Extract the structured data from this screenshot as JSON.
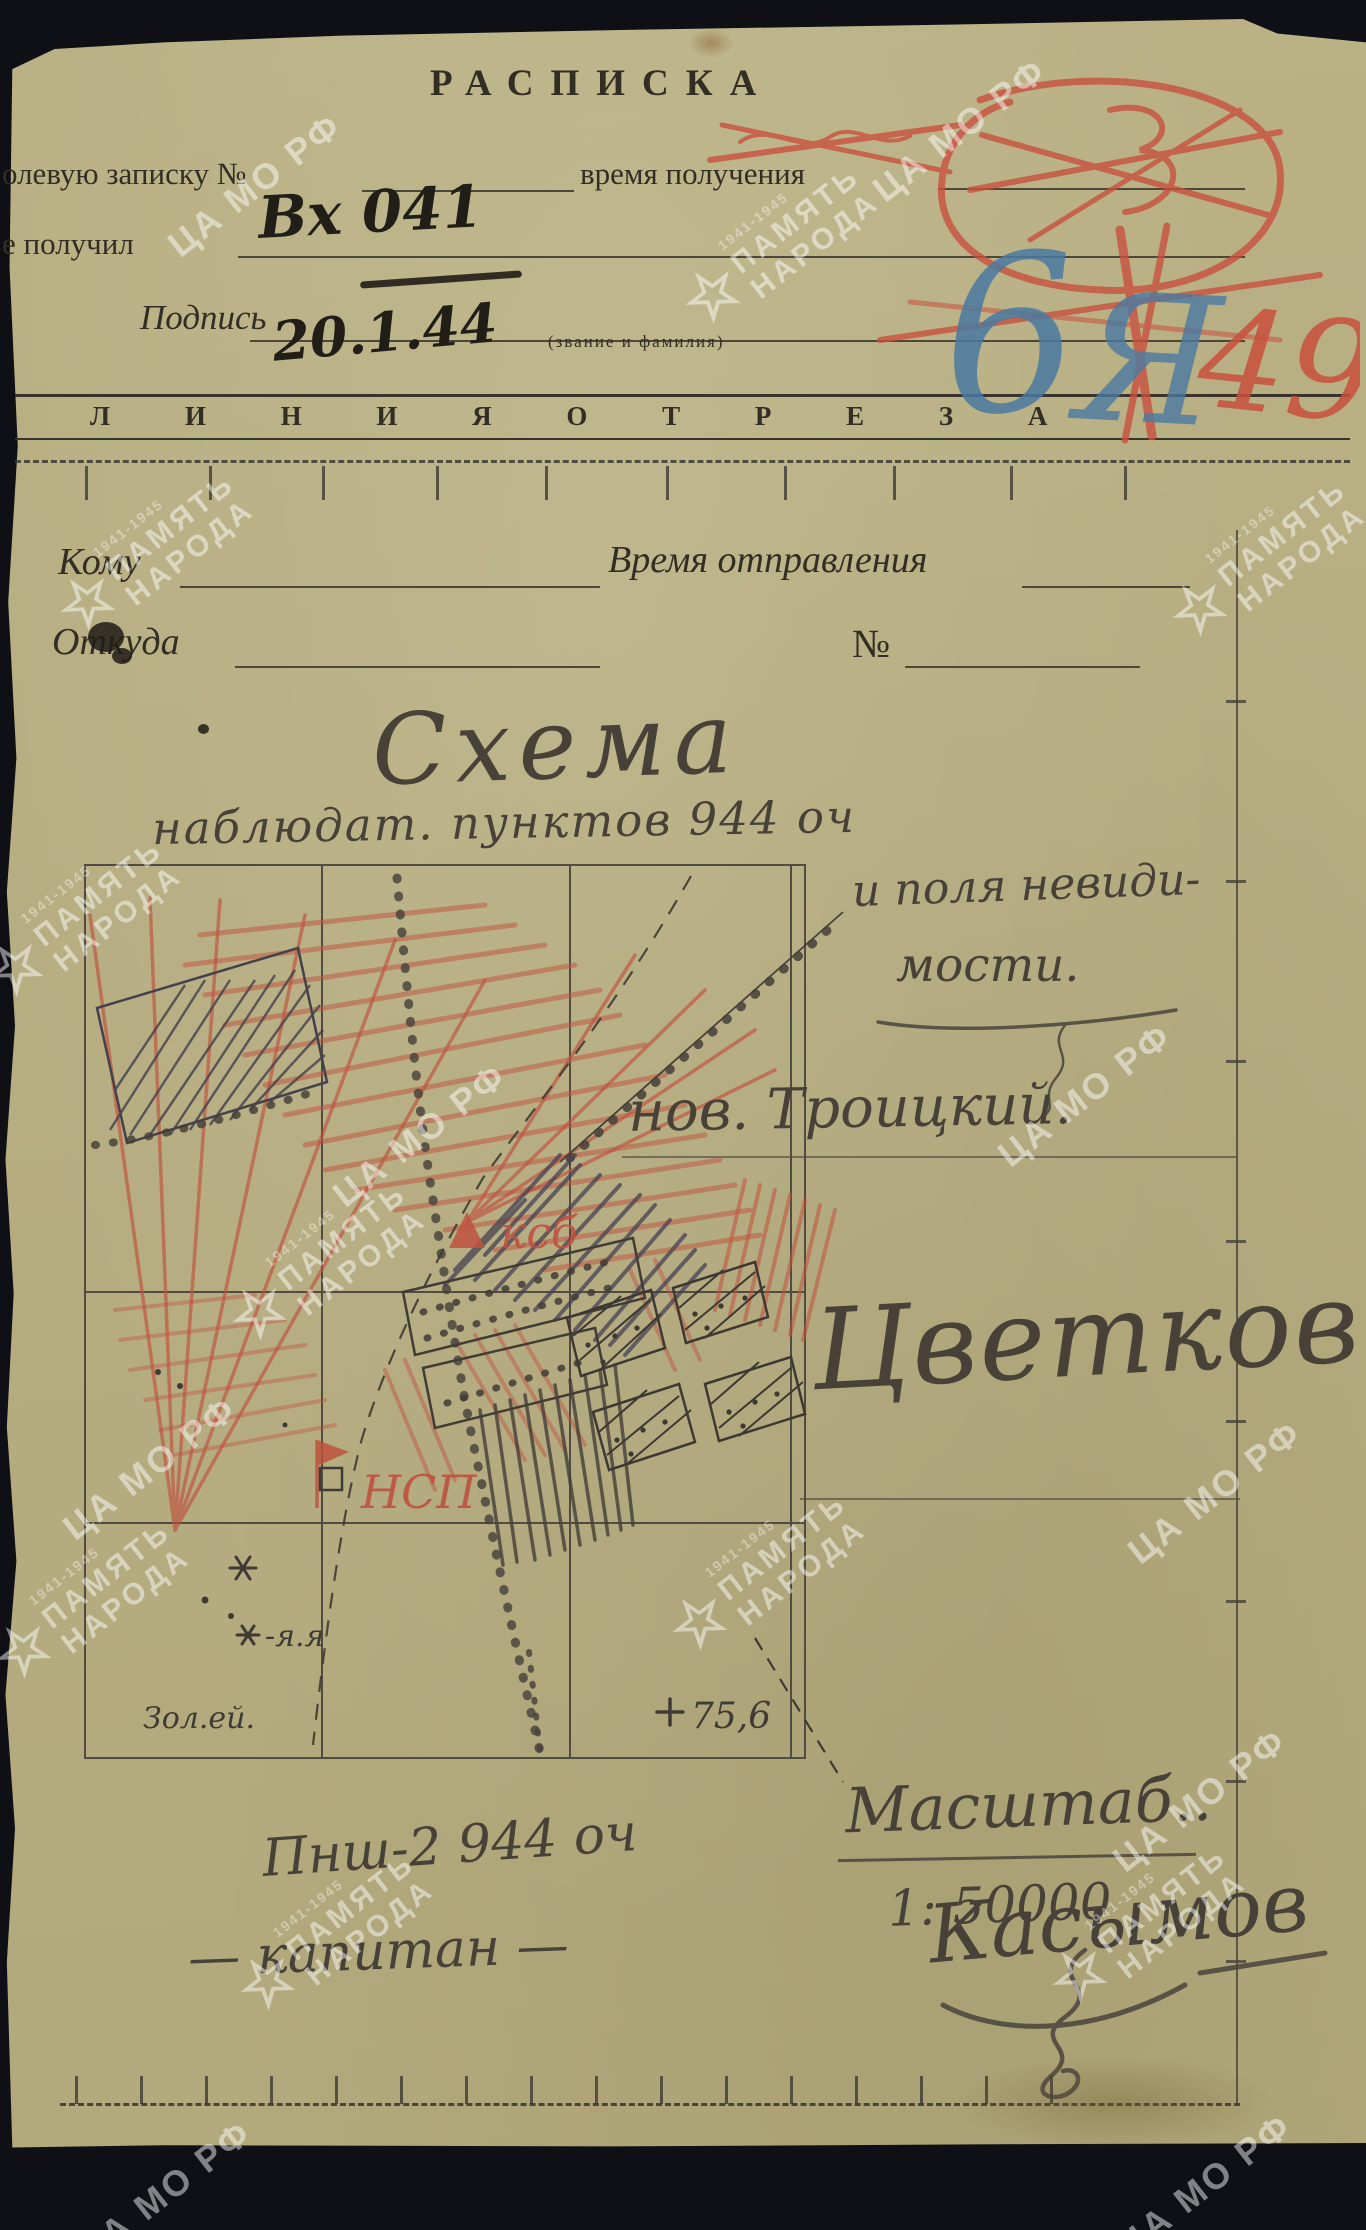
{
  "receipt": {
    "title": "РАСПИСКА",
    "field1_label": "олевую записку №",
    "field1b_label": "время получения",
    "field2_label": "е получил",
    "field2_value": "Вх 041",
    "signature_label": "Подпись",
    "signature_date": "20.1.44",
    "rank_hint": "(звание и фамилия)",
    "blue_mark_1": "6",
    "blue_mark_2": "Я",
    "red_mark": "49"
  },
  "cutline": {
    "text": "Л И Н И Я  О Т Р Е З А"
  },
  "dispatch": {
    "to": "Кому",
    "time": "Время отправления",
    "from": "Откуда",
    "number": "№"
  },
  "schema": {
    "title": "Схема",
    "subtitle": "наблюдат. пунктов  944 оч",
    "note1": "и поля невиди-",
    "note2": "мости.",
    "village": "нов. Троицкий.",
    "observer_sig": "Цветков",
    "scale_label": "Масштаб..",
    "scale_value": "1: 50000",
    "height_mark": "75,6",
    "label_ksb": "ксб",
    "label_nsp": "НСП",
    "landmark1": "-я.я",
    "landmark2": "Зол.ей.",
    "footer1": "Пнш-2  944 оч",
    "footer2a": "— капитан —",
    "footer2b": "Касымов"
  },
  "watermark": {
    "archive": "ЦА МО РФ",
    "memory_top": "ПАМЯТЬ",
    "memory_bottom": "НАРОДА",
    "years": "1941-1945"
  },
  "colors": {
    "paper": "#b7ae83",
    "background": "#0e1016",
    "print_ink": "#332e24",
    "pencil": "#474138",
    "red_pencil": "#c0523f",
    "blue_pencil": "#4a7aa2"
  }
}
